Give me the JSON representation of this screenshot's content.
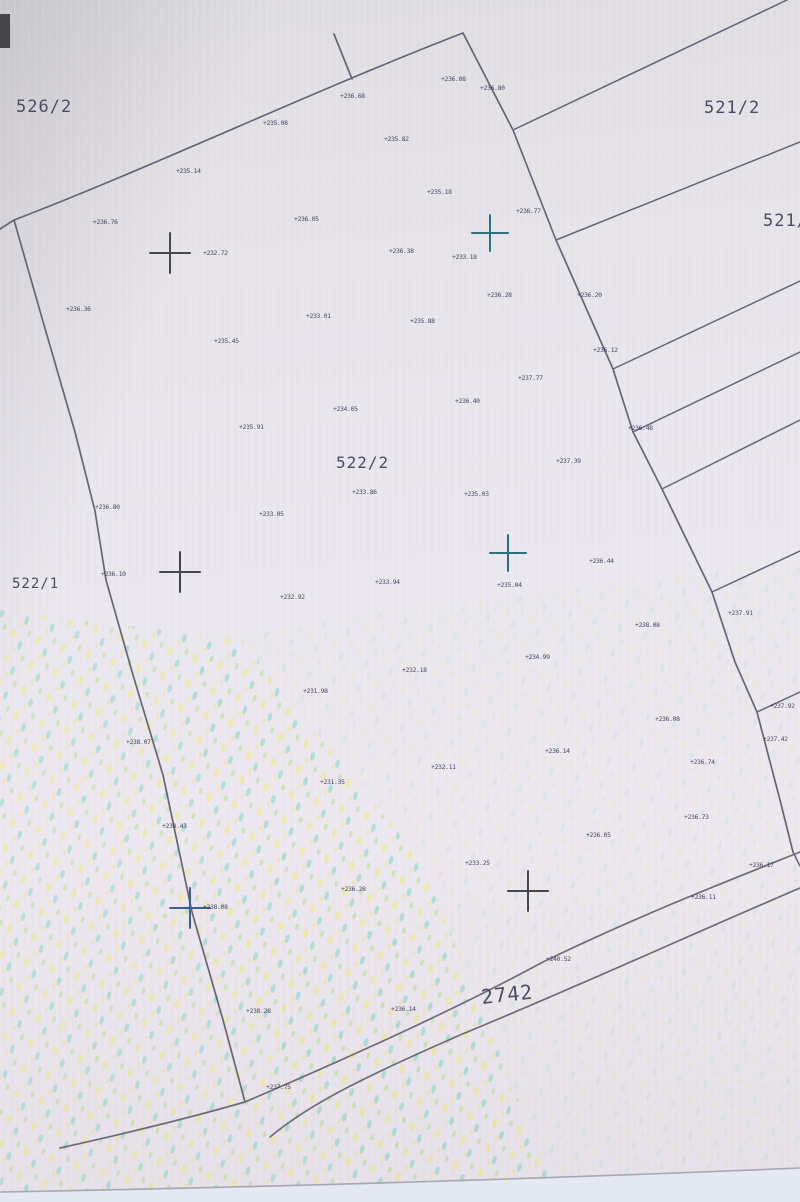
{
  "map": {
    "colors": {
      "line": "#5a5b6e",
      "road": "#63626f",
      "tiny_text": "#333350",
      "parcel_text": "#3d3d57",
      "cross_dark": "#46464f",
      "cross_teal": "#2e7080",
      "cross_blue": "#3a5f96",
      "paper_edge": "#a3a6b2",
      "corner_mark": "#262626"
    },
    "parcel_labels": [
      {
        "id": "parcel-526-2",
        "text": "526/2",
        "x": 16,
        "y": 112,
        "size": 17,
        "rotate": 0
      },
      {
        "id": "parcel-521-2",
        "text": "521/2",
        "x": 704,
        "y": 113,
        "size": 17,
        "rotate": 0
      },
      {
        "id": "parcel-521-1",
        "text": "521/1",
        "x": 763,
        "y": 226,
        "size": 17,
        "rotate": 0
      },
      {
        "id": "parcel-522-2",
        "text": "522/2",
        "x": 336,
        "y": 468,
        "size": 16,
        "rotate": 0
      },
      {
        "id": "parcel-522-1",
        "text": "522/1",
        "x": 12,
        "y": 588,
        "size": 14,
        "rotate": 0
      },
      {
        "id": "parcel-2742",
        "text": "2742",
        "x": 482,
        "y": 1004,
        "size": 20,
        "rotate": -6
      }
    ],
    "boundary_lines": [
      {
        "id": "top-boundary",
        "d": "M 0,229 L 14,220 C 150,168 320,88 463,33",
        "color": "line",
        "w": 1.7
      },
      {
        "id": "top-tick",
        "d": "M 334,34 L 352,79",
        "color": "line",
        "w": 1.7
      },
      {
        "id": "right-boundary",
        "d": "M 463,33 L 513,130 L 556,240 L 613,369 L 633,432 L 662,489 L 712,592 L 735,662 L 757,712 L 780,800 L 793,852",
        "color": "line",
        "w": 1.7
      },
      {
        "id": "left-boundary",
        "d": "M 14,220 L 42,318 L 75,432 L 95,511 L 106,580 L 133,675 L 163,775 L 192,912 L 223,1020 L 245,1102",
        "color": "line",
        "w": 1.7
      },
      {
        "id": "road-upper-line",
        "d": "M 60,1148 C 150,1128 210,1112 245,1102 C 350,1057 450,1012 543,962 C 640,915 730,880 800,852",
        "color": "road",
        "w": 1.7
      },
      {
        "id": "road-lower-line",
        "d": "M 270,1137 C 320,1095 400,1062 460,1035 C 570,990 690,935 800,888",
        "color": "road",
        "w": 1.7
      },
      {
        "id": "strip-line-1",
        "d": "M 513,130 L 787,0",
        "color": "line",
        "w": 1.5
      },
      {
        "id": "strip-line-2",
        "d": "M 556,240 L 800,142",
        "color": "line",
        "w": 1.5
      },
      {
        "id": "strip-line-3",
        "d": "M 613,369 L 800,281",
        "color": "line",
        "w": 1.5
      },
      {
        "id": "strip-line-4",
        "d": "M 633,432 L 800,352",
        "color": "line",
        "w": 1.5
      },
      {
        "id": "strip-line-5",
        "d": "M 662,489 L 800,420",
        "color": "line",
        "w": 1.5
      },
      {
        "id": "strip-line-6",
        "d": "M 712,592 L 800,551",
        "color": "line",
        "w": 1.5
      },
      {
        "id": "strip-line-7",
        "d": "M 757,712 L 800,692",
        "color": "line",
        "w": 1.5
      },
      {
        "id": "edge-stub",
        "d": "M 793,852 L 800,866",
        "color": "line",
        "w": 1.5
      },
      {
        "id": "paper-edge-line",
        "d": "M 0,1192 C 280,1187 560,1178 800,1168",
        "color": "paper_edge",
        "w": 1.6
      }
    ],
    "crosses": [
      {
        "id": "survey-cross-1",
        "x": 170,
        "y": 253,
        "r": 20,
        "color": "cross_dark"
      },
      {
        "id": "survey-cross-2",
        "x": 490,
        "y": 233,
        "r": 18,
        "color": "cross_teal"
      },
      {
        "id": "survey-cross-3",
        "x": 180,
        "y": 572,
        "r": 20,
        "color": "cross_dark"
      },
      {
        "id": "survey-cross-4",
        "x": 508,
        "y": 553,
        "r": 18,
        "color": "cross_teal"
      },
      {
        "id": "survey-cross-5",
        "x": 190,
        "y": 908,
        "r": 20,
        "color": "cross_blue"
      },
      {
        "id": "survey-cross-6",
        "x": 528,
        "y": 891,
        "r": 20,
        "color": "cross_dark"
      }
    ],
    "elevation_points": [
      {
        "x": 340,
        "y": 98,
        "v": "+236.68"
      },
      {
        "x": 263,
        "y": 125,
        "v": "+235.08"
      },
      {
        "x": 441,
        "y": 81,
        "v": "+236.08"
      },
      {
        "x": 480,
        "y": 90,
        "v": "+236.80"
      },
      {
        "x": 176,
        "y": 173,
        "v": "+235.14"
      },
      {
        "x": 93,
        "y": 224,
        "v": "+236.76"
      },
      {
        "x": 294,
        "y": 221,
        "v": "+236.05"
      },
      {
        "x": 384,
        "y": 141,
        "v": "+235.82"
      },
      {
        "x": 427,
        "y": 194,
        "v": "+235.18"
      },
      {
        "x": 516,
        "y": 213,
        "v": "+236.77"
      },
      {
        "x": 389,
        "y": 253,
        "v": "+236.38"
      },
      {
        "x": 203,
        "y": 255,
        "v": "+232.72"
      },
      {
        "x": 452,
        "y": 259,
        "v": "+233.18"
      },
      {
        "x": 66,
        "y": 311,
        "v": "+236.36"
      },
      {
        "x": 306,
        "y": 318,
        "v": "+233.01"
      },
      {
        "x": 214,
        "y": 343,
        "v": "+235.45"
      },
      {
        "x": 410,
        "y": 323,
        "v": "+235.88"
      },
      {
        "x": 487,
        "y": 297,
        "v": "+236.28"
      },
      {
        "x": 577,
        "y": 297,
        "v": "+236.20"
      },
      {
        "x": 593,
        "y": 352,
        "v": "+236.12"
      },
      {
        "x": 518,
        "y": 380,
        "v": "+237.77"
      },
      {
        "x": 455,
        "y": 403,
        "v": "+236.40"
      },
      {
        "x": 333,
        "y": 411,
        "v": "+234.05"
      },
      {
        "x": 239,
        "y": 429,
        "v": "+235.91"
      },
      {
        "x": 556,
        "y": 463,
        "v": "+237.39"
      },
      {
        "x": 628,
        "y": 430,
        "v": "+236.48"
      },
      {
        "x": 352,
        "y": 494,
        "v": "+233.86"
      },
      {
        "x": 464,
        "y": 496,
        "v": "+235.03"
      },
      {
        "x": 259,
        "y": 516,
        "v": "+233.05"
      },
      {
        "x": 95,
        "y": 509,
        "v": "+236.80"
      },
      {
        "x": 280,
        "y": 599,
        "v": "+232.92"
      },
      {
        "x": 101,
        "y": 576,
        "v": "+236.10"
      },
      {
        "x": 589,
        "y": 563,
        "v": "+236.44"
      },
      {
        "x": 375,
        "y": 584,
        "v": "+233.94"
      },
      {
        "x": 497,
        "y": 587,
        "v": "+235.04"
      },
      {
        "x": 635,
        "y": 627,
        "v": "+238.08"
      },
      {
        "x": 728,
        "y": 615,
        "v": "+237.91"
      },
      {
        "x": 525,
        "y": 659,
        "v": "+234.99"
      },
      {
        "x": 402,
        "y": 672,
        "v": "+232.18"
      },
      {
        "x": 303,
        "y": 693,
        "v": "+231.98"
      },
      {
        "x": 655,
        "y": 721,
        "v": "+236.08"
      },
      {
        "x": 770,
        "y": 708,
        "v": "+237.92"
      },
      {
        "x": 763,
        "y": 741,
        "v": "+237.42"
      },
      {
        "x": 126,
        "y": 744,
        "v": "+238.07"
      },
      {
        "x": 545,
        "y": 753,
        "v": "+236.14"
      },
      {
        "x": 690,
        "y": 764,
        "v": "+236.74"
      },
      {
        "x": 431,
        "y": 769,
        "v": "+232.11"
      },
      {
        "x": 320,
        "y": 784,
        "v": "+231.35"
      },
      {
        "x": 162,
        "y": 828,
        "v": "+238.43"
      },
      {
        "x": 684,
        "y": 819,
        "v": "+236.73"
      },
      {
        "x": 586,
        "y": 837,
        "v": "+236.05"
      },
      {
        "x": 465,
        "y": 865,
        "v": "+233.25"
      },
      {
        "x": 749,
        "y": 867,
        "v": "+236.17"
      },
      {
        "x": 203,
        "y": 909,
        "v": "+238.08"
      },
      {
        "x": 341,
        "y": 891,
        "v": "+236.28"
      },
      {
        "x": 691,
        "y": 899,
        "v": "+236.11"
      },
      {
        "x": 546,
        "y": 961,
        "v": "+240.52"
      },
      {
        "x": 391,
        "y": 1011,
        "v": "+236.14"
      },
      {
        "x": 246,
        "y": 1013,
        "v": "+238.28"
      },
      {
        "x": 266,
        "y": 1089,
        "v": "+237.75"
      }
    ]
  }
}
